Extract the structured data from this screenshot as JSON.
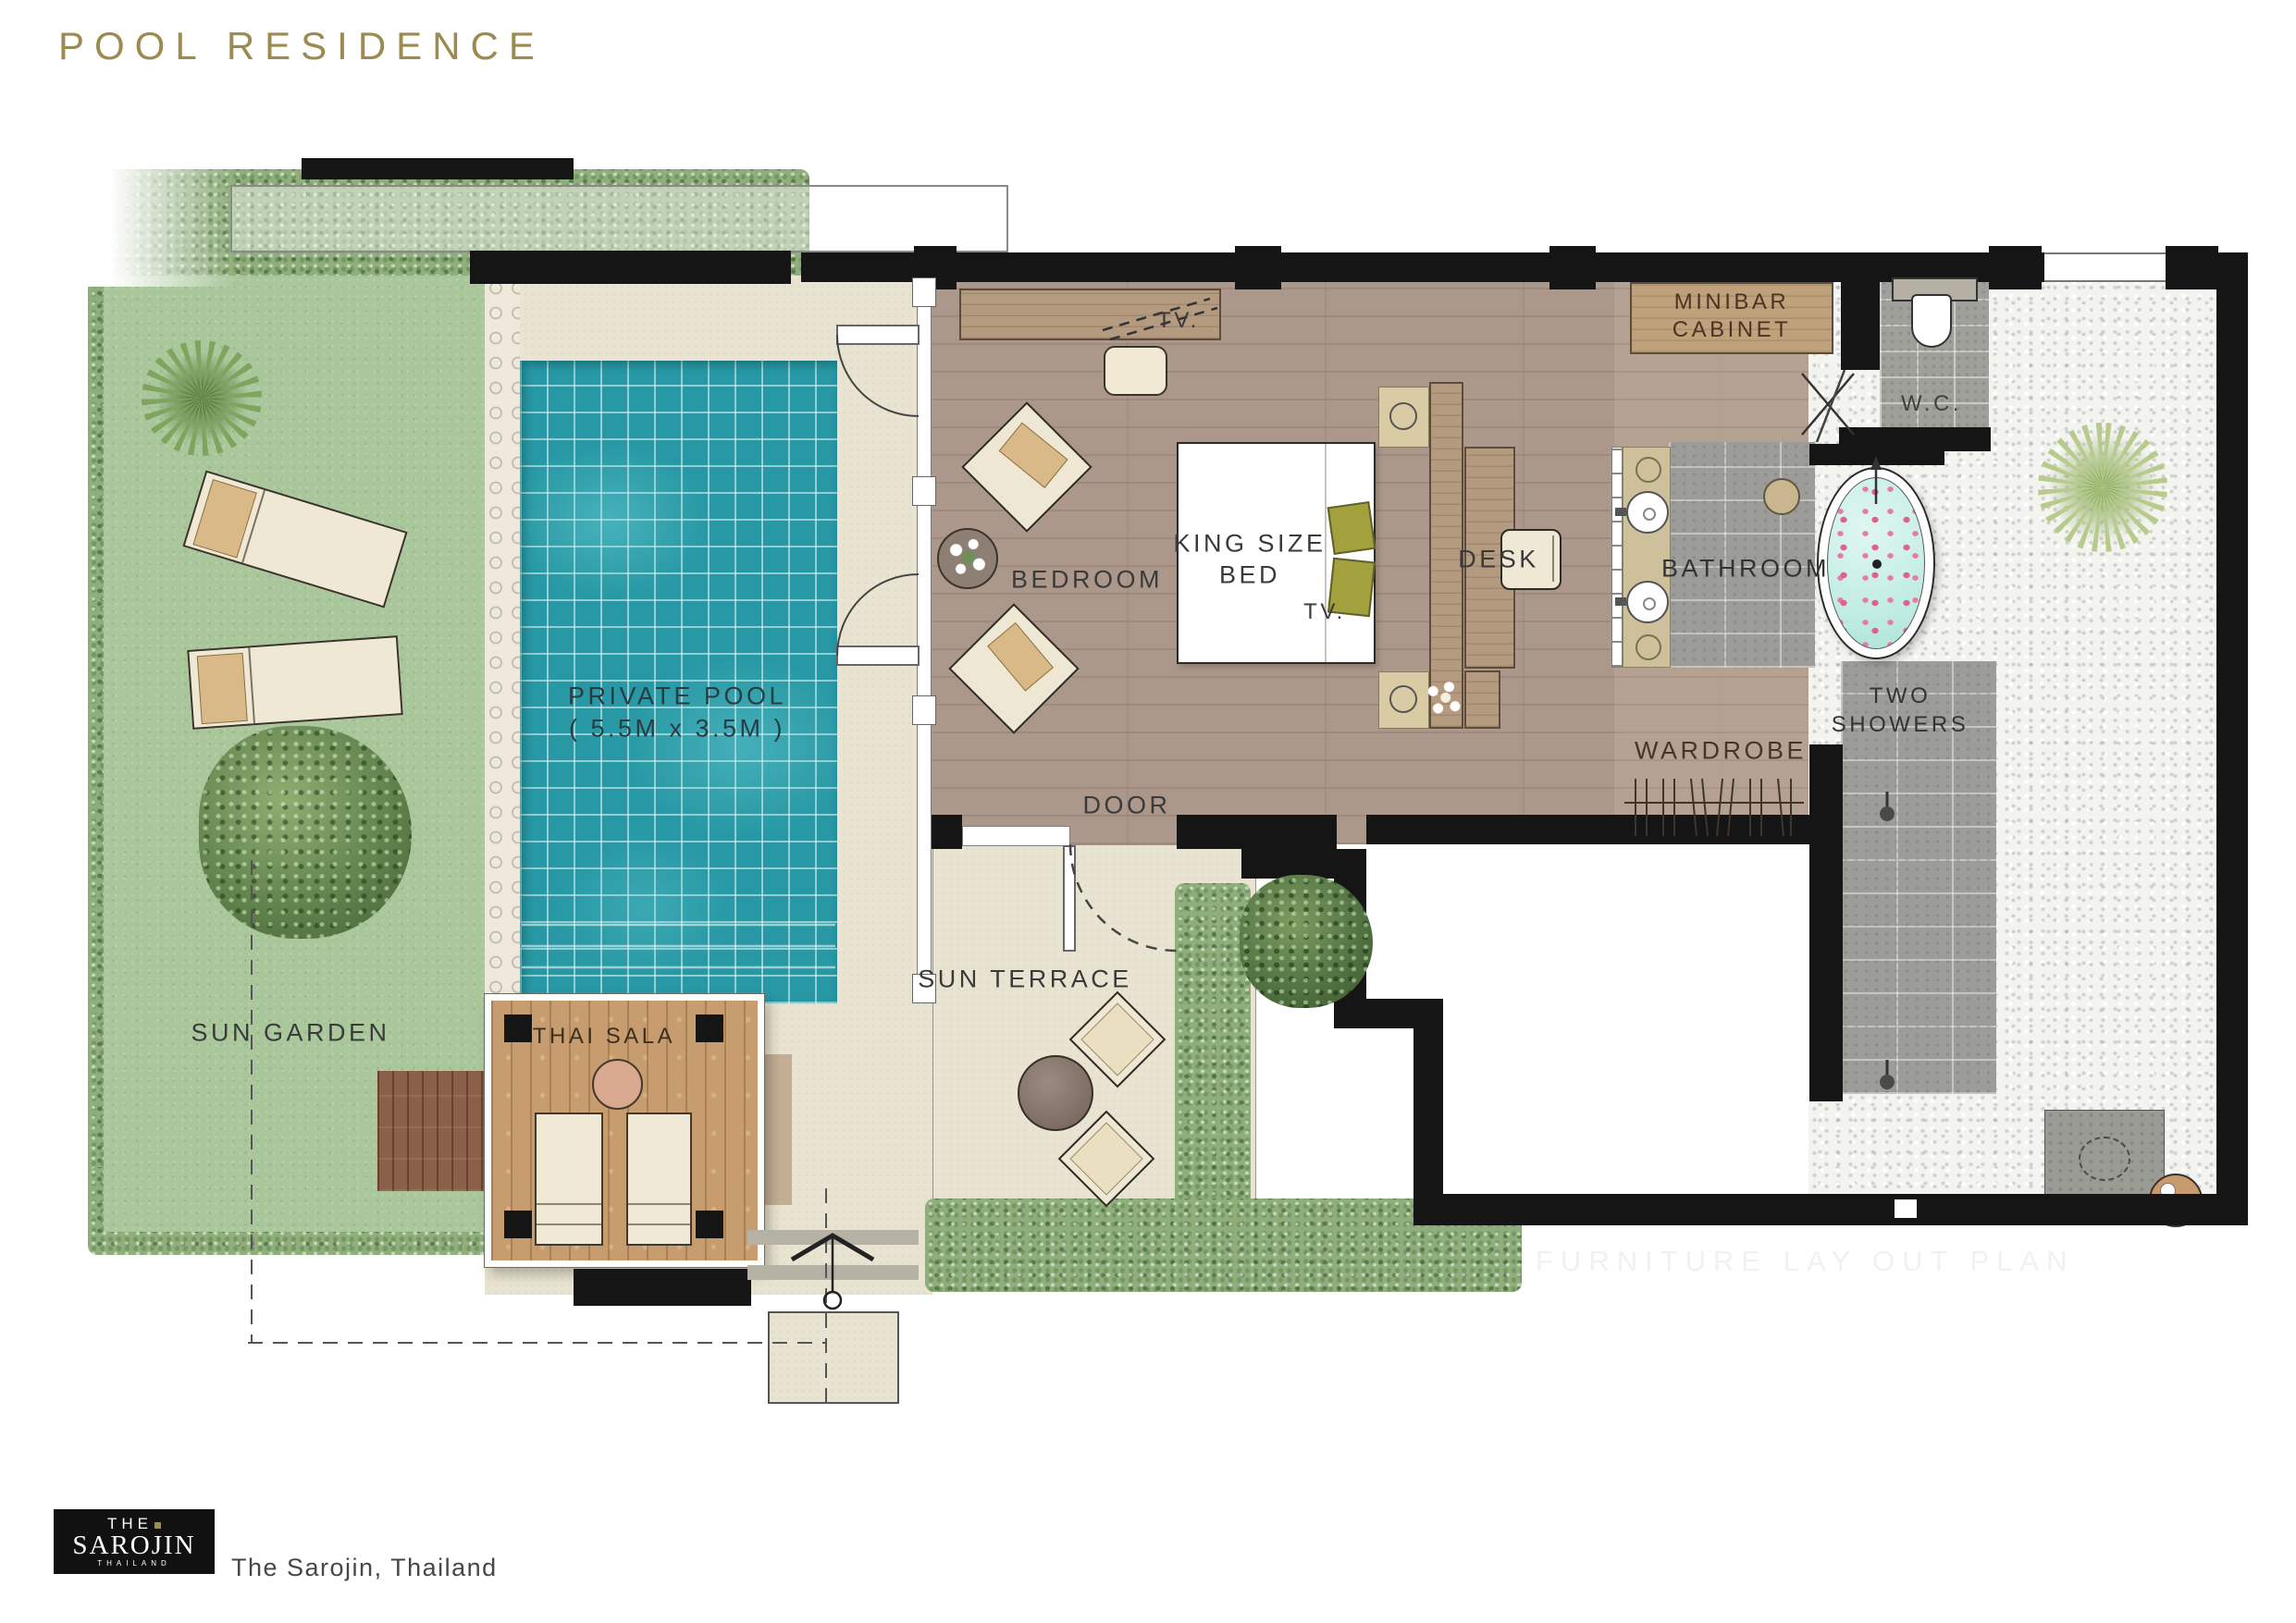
{
  "title": "POOL RESIDENCE",
  "plan": {
    "labels": {
      "sun_garden": "SUN GARDEN",
      "thai_sala": "THAI SALA",
      "private_pool_1": "PRIVATE POOL",
      "private_pool_2": "( 5.5M x 3.5M )",
      "sun_terrace": "SUN TERRACE",
      "bedroom": "BEDROOM",
      "door": "DOOR",
      "king_bed_1": "KING SIZE",
      "king_bed_2": "BED",
      "tv_console": "TV.",
      "tv_bed": "TV.",
      "desk": "DESK",
      "minibar_1": "MINIBAR",
      "minibar_2": "CABINET",
      "wc": "W.C.",
      "bathroom": "BATHROOM",
      "two_showers_1": "TWO",
      "two_showers_2": "SHOWERS",
      "wardrobe": "WARDROBE"
    }
  },
  "watermark": "FURNITURE LAY OUT PLAN",
  "footer": {
    "logo_line1": "THE",
    "logo_line2": "SAROJIN",
    "logo_line3": "THAILAND",
    "caption": "The Sarojin, Thailand"
  },
  "colors": {
    "accent_gold": "#9c8b50",
    "pool_teal": "#2798a4",
    "grass_green": "#a9c79b",
    "hedge_green": "#8fae7c",
    "wood_floor": "#ab988a",
    "sala_wood": "#c79d6f",
    "wall_black": "#151515",
    "pebble_white": "#f3f3f0",
    "tile_grey": "#9c9c98",
    "pillow_olive": "#a3a03e",
    "bath_water": "#c2ece4",
    "petal_pink": "#e0608a"
  }
}
